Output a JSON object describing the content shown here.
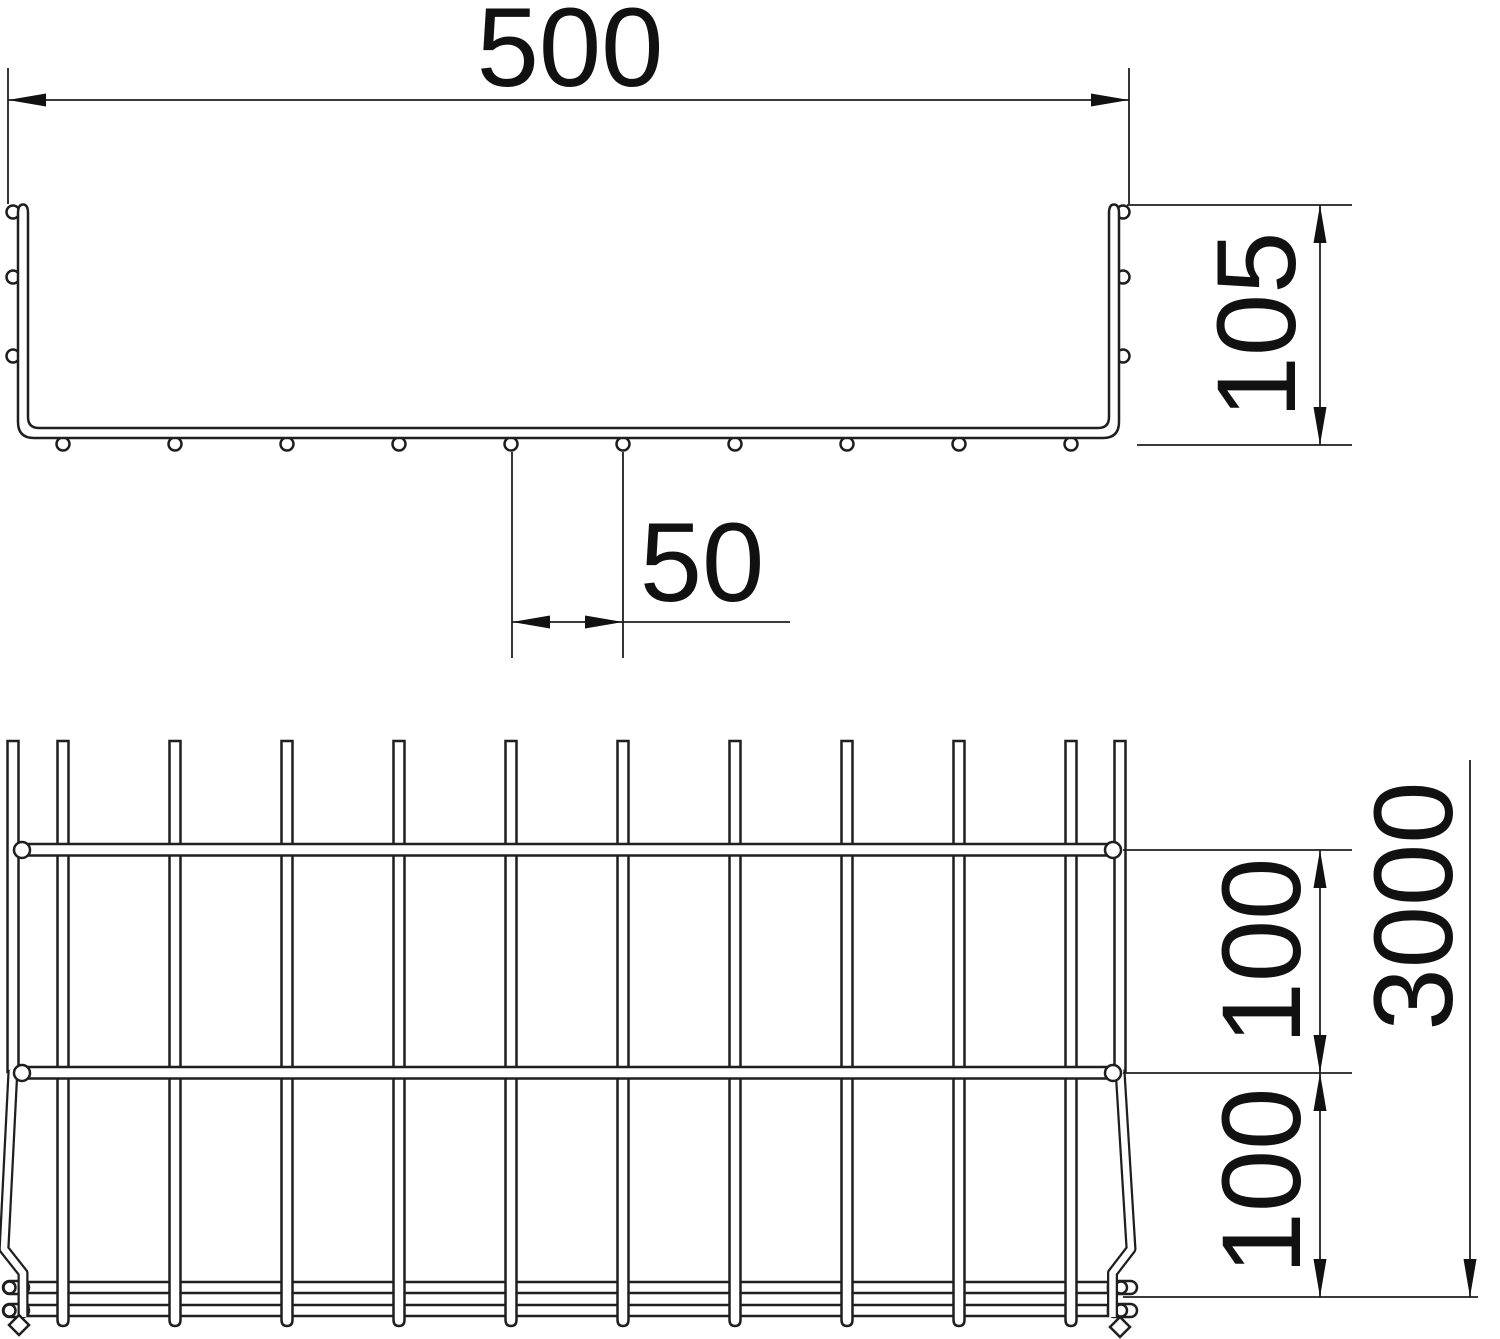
{
  "drawing": {
    "kind": "mesh-cable-tray-technical-drawing",
    "colors": {
      "background": "#ffffff",
      "line": "#1f1f1f",
      "text": "#111111"
    },
    "cross_section": {
      "width_dim": {
        "label": "500"
      },
      "height_dim": {
        "label": "105"
      },
      "wire_pitch_dim": {
        "label": "50"
      },
      "bottom_wire_count": 10,
      "side_wire_rows": 3
    },
    "plan_view": {
      "rung_pitch_dim_top": {
        "label": "100"
      },
      "rung_pitch_dim_bottom": {
        "label": "100"
      },
      "length_dim": {
        "label": "3000"
      },
      "longitudinal_wire_count": 10,
      "rung_count": 2
    }
  }
}
